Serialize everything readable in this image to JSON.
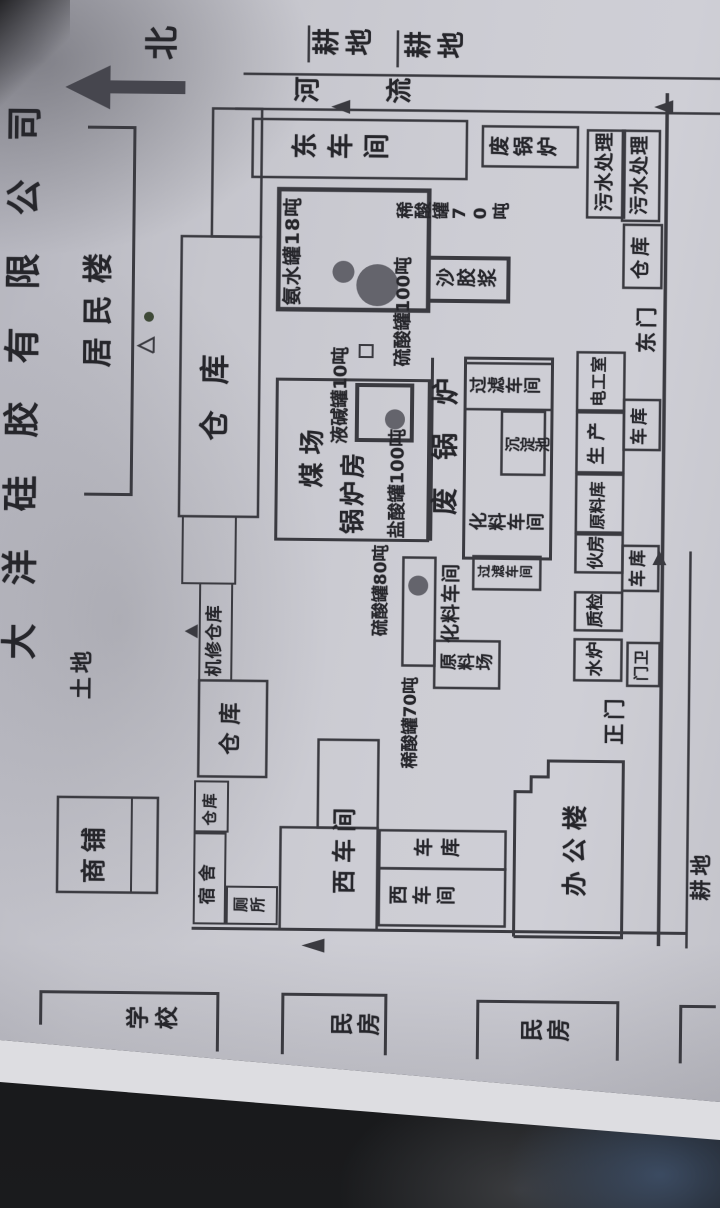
{
  "title": {
    "text": "大洋硅胶有限公司"
  },
  "colors": {
    "ink": "#3a3a40",
    "text": "#26262b",
    "tank_fill": "#64646c",
    "paper": "#c9c9d0"
  },
  "map": {
    "labels": [
      {
        "name": "company-title",
        "text": "大洋硅胶有限公司",
        "x": 545,
        "y": 2,
        "fs": 36,
        "ls": 38,
        "o": "h"
      },
      {
        "name": "north-label",
        "text": "北",
        "x": 1146,
        "y": 140,
        "fs": 34,
        "o": "h"
      },
      {
        "name": "farmland-east-1",
        "text": "耕地",
        "x": 1148,
        "y": 306,
        "fs": 27,
        "ls": 6,
        "o": "v"
      },
      {
        "name": "farmland-east-2",
        "text": "耕地",
        "x": 1146,
        "y": 398,
        "fs": 27,
        "ls": 6,
        "o": "v"
      },
      {
        "name": "river-label",
        "text": "河流",
        "x": 1101,
        "y": 288,
        "fs": 26,
        "ls": 66,
        "o": "v"
      },
      {
        "name": "land-label",
        "text": "土地",
        "x": 506,
        "y": 72,
        "fs": 22,
        "ls": 4,
        "o": "h"
      },
      {
        "name": "residents-building",
        "text": "居民楼",
        "x": 838,
        "y": 80,
        "fs": 30,
        "ls": 12,
        "o": "h"
      },
      {
        "name": "shops",
        "text": "商铺",
        "x": 322,
        "y": 84,
        "fs": 25,
        "ls": 6,
        "o": "h"
      },
      {
        "name": "warehouse-band",
        "text": "仓库",
        "x": 766,
        "y": 198,
        "fs": 30,
        "ls": 26,
        "o": "h"
      },
      {
        "name": "machine-repair-warehouse",
        "text": "机修仓库",
        "x": 530,
        "y": 207,
        "fs": 17,
        "ls": 1,
        "o": "h"
      },
      {
        "name": "warehouse-big",
        "text": "仓库",
        "x": 452,
        "y": 221,
        "fs": 22,
        "ls": 8,
        "o": "h"
      },
      {
        "name": "warehouse-small",
        "text": "仓库",
        "x": 381,
        "y": 205,
        "fs": 15,
        "ls": 2,
        "o": "h"
      },
      {
        "name": "dormitory",
        "text": "宿舍",
        "x": 302,
        "y": 203,
        "fs": 17,
        "ls": 6,
        "o": "h"
      },
      {
        "name": "toilet",
        "text": "厕所",
        "x": 293,
        "y": 236,
        "fs": 15,
        "ls": 2,
        "o": "v"
      },
      {
        "name": "east-workshop",
        "text": "东车间",
        "x": 1045,
        "y": 286,
        "fs": 26,
        "ls": 10,
        "o": "v"
      },
      {
        "name": "waste-boiler-room",
        "text": "废锅炉",
        "x": 1051,
        "y": 484,
        "fs": 20,
        "ls": 4,
        "o": "v"
      },
      {
        "name": "sewage-treatment-1",
        "text": "污水处理",
        "x": 999,
        "y": 591,
        "fs": 19,
        "ls": 1,
        "o": "h"
      },
      {
        "name": "sewage-treatment-2",
        "text": "污水处理",
        "x": 996,
        "y": 626,
        "fs": 19,
        "ls": 1,
        "o": "h"
      },
      {
        "name": "warehouse-east",
        "text": "仓库",
        "x": 932,
        "y": 628,
        "fs": 19,
        "ls": 4,
        "o": "h"
      },
      {
        "name": "east-gate",
        "text": "东门",
        "x": 858,
        "y": 633,
        "fs": 21,
        "ls": 4,
        "o": "h"
      },
      {
        "name": "ammonia-tank-18t",
        "text": "氨水罐18吨",
        "x": 902,
        "y": 280,
        "fs": 19,
        "ls": 1,
        "o": "h"
      },
      {
        "name": "sulfuric-acid-tank-100t",
        "text": "硫酸罐100吨",
        "x": 842,
        "y": 392,
        "fs": 18,
        "ls": 0,
        "o": "h"
      },
      {
        "name": "dilute-acid-tank-70t-a",
        "text": "稀酸罐70吨",
        "x": 986,
        "y": 392,
        "fs": 17,
        "ls": 1,
        "o": "v"
      },
      {
        "name": "sand-gel-slurry",
        "text": "沙胶浆",
        "x": 919,
        "y": 432,
        "fs": 19,
        "ls": 2,
        "o": "v"
      },
      {
        "name": "coal-yard",
        "text": "煤场",
        "x": 720,
        "y": 298,
        "fs": 25,
        "ls": 8,
        "o": "h"
      },
      {
        "name": "boiler-room",
        "text": "锅炉房",
        "x": 674,
        "y": 339,
        "fs": 25,
        "ls": 3,
        "o": "h"
      },
      {
        "name": "liquid-caustic-tank-10t",
        "text": "液碱罐10吨",
        "x": 764,
        "y": 330,
        "fs": 18,
        "ls": 0,
        "o": "h"
      },
      {
        "name": "hydrochloric-tank-100t",
        "text": "盐酸罐100吨",
        "x": 670,
        "y": 388,
        "fs": 18,
        "ls": 0,
        "o": "h"
      },
      {
        "name": "waste-boiler-big",
        "text": "废锅炉",
        "x": 694,
        "y": 431,
        "fs": 27,
        "ls": 28,
        "o": "h"
      },
      {
        "name": "filter-workshop-1",
        "text": "过滤车间",
        "x": 812,
        "y": 467,
        "fs": 17,
        "ls": 1,
        "o": "v"
      },
      {
        "name": "sedimentation-pool",
        "text": "沉淀池",
        "x": 756,
        "y": 503,
        "fs": 15,
        "ls": 0,
        "o": "v"
      },
      {
        "name": "chemical-workshop-1",
        "text": "化料车间",
        "x": 676,
        "y": 468,
        "fs": 18,
        "ls": 1,
        "o": "v"
      },
      {
        "name": "filter-workshop-2",
        "text": "过滤车间",
        "x": 629,
        "y": 477,
        "fs": 13,
        "ls": 1,
        "o": "v"
      },
      {
        "name": "chemical-workshop-2",
        "text": "化料车间",
        "x": 566,
        "y": 442,
        "fs": 19,
        "ls": 1,
        "o": "h"
      },
      {
        "name": "raw-material-yard",
        "text": "原料场",
        "x": 535,
        "y": 440,
        "fs": 17,
        "ls": 1,
        "o": "v"
      },
      {
        "name": "sulfuric-acid-tank-80t",
        "text": "硫酸罐80吨",
        "x": 572,
        "y": 373,
        "fs": 17,
        "ls": 0,
        "o": "h"
      },
      {
        "name": "dilute-acid-tank-70t-b",
        "text": "稀酸罐70吨",
        "x": 440,
        "y": 404,
        "fs": 17,
        "ls": 0,
        "o": "h"
      },
      {
        "name": "water-boiler",
        "text": "水炉",
        "x": 534,
        "y": 588,
        "fs": 17,
        "ls": 1,
        "o": "h"
      },
      {
        "name": "quality-check",
        "text": "质检",
        "x": 583,
        "y": 588,
        "fs": 17,
        "ls": 0,
        "o": "h"
      },
      {
        "name": "kitchen",
        "text": "伙房",
        "x": 641,
        "y": 588,
        "fs": 17,
        "ls": 0,
        "o": "h"
      },
      {
        "name": "raw-material-warehouse",
        "text": "原料库",
        "x": 681,
        "y": 589,
        "fs": 16,
        "ls": 0,
        "o": "h"
      },
      {
        "name": "production",
        "text": "生产",
        "x": 746,
        "y": 587,
        "fs": 18,
        "ls": 6,
        "o": "h"
      },
      {
        "name": "electrician-room",
        "text": "电工室",
        "x": 804,
        "y": 589,
        "fs": 16,
        "ls": 1,
        "o": "h"
      },
      {
        "name": "gate-guard",
        "text": "门卫",
        "x": 530,
        "y": 635,
        "fs": 15,
        "ls": 1,
        "o": "h"
      },
      {
        "name": "garage-2",
        "text": "车库",
        "x": 624,
        "y": 630,
        "fs": 17,
        "ls": 3,
        "o": "h"
      },
      {
        "name": "garage-1",
        "text": "车库",
        "x": 766,
        "y": 630,
        "fs": 17,
        "ls": 3,
        "o": "h"
      },
      {
        "name": "main-gate",
        "text": "正门",
        "x": 466,
        "y": 605,
        "fs": 21,
        "ls": 4,
        "o": "h"
      },
      {
        "name": "west-workshop-1",
        "text": "西车间",
        "x": 314,
        "y": 335,
        "fs": 24,
        "ls": 7,
        "o": "h"
      },
      {
        "name": "garage-strip",
        "text": "车库",
        "x": 349,
        "y": 416,
        "fs": 19,
        "ls": 8,
        "o": "v"
      },
      {
        "name": "west-workshop-2",
        "text": "西车间",
        "x": 301,
        "y": 391,
        "fs": 19,
        "ls": 5,
        "o": "v"
      },
      {
        "name": "office-building",
        "text": "办公楼",
        "x": 314,
        "y": 565,
        "fs": 25,
        "ls": 8,
        "o": "h"
      },
      {
        "name": "school",
        "text": "学校",
        "x": 173,
        "y": 130,
        "fs": 23,
        "ls": 6,
        "o": "v"
      },
      {
        "name": "civilian-house-1",
        "text": "民房",
        "x": 169,
        "y": 334,
        "fs": 23,
        "ls": 4,
        "o": "v"
      },
      {
        "name": "civilian-house-2",
        "text": "民房",
        "x": 165,
        "y": 524,
        "fs": 23,
        "ls": 4,
        "o": "v"
      },
      {
        "name": "farmland-south",
        "text": "耕地",
        "x": 311,
        "y": 693,
        "fs": 21,
        "ls": 4,
        "o": "h"
      }
    ],
    "shapes": [
      {
        "name": "north-arrow-shaft",
        "k": "g",
        "pts": "1112,98 1125,98 1125,180 1112,180",
        "f": "#46464e"
      },
      {
        "name": "north-arrow-head",
        "k": "g",
        "pts": "1096,105 1140,105 1118,60",
        "f": "#46464e"
      },
      {
        "name": "field-tick-1",
        "k": "l",
        "x1": 1145,
        "y1": 303,
        "x2": 1182,
        "y2": 303,
        "sw": 2.5
      },
      {
        "name": "field-tick-2",
        "k": "l",
        "x1": 1141,
        "y1": 392,
        "x2": 1178,
        "y2": 392,
        "sw": 2.5
      },
      {
        "name": "river-line-outer",
        "k": "l",
        "x1": 1133,
        "y1": 238,
        "x2": 1133,
        "y2": 720,
        "sw": 2.5
      },
      {
        "name": "river-line-inner",
        "k": "l",
        "x1": 1098,
        "y1": 230,
        "x2": 1098,
        "y2": 720,
        "sw": 2.5
      },
      {
        "name": "river-flow-arrow-1",
        "k": "g",
        "pts": "1094,345 1108,345 1101,326",
        "f": "#3a3a40"
      },
      {
        "name": "river-flow-arrow-2",
        "k": "g",
        "pts": "1097,668 1111,668 1104,649",
        "f": "#3a3a40"
      },
      {
        "name": "residents-line",
        "k": "p",
        "pts": "711,83 711,130 1078,130 1078,83",
        "sw": 3
      },
      {
        "name": "residents-dot",
        "k": "c",
        "cx": 889,
        "cy": 146,
        "r": 5,
        "f": "#3f4a38"
      },
      {
        "name": "residents-triangle",
        "k": "p",
        "pts": "853,151 860,136 868,151 853,151",
        "sw": 2
      },
      {
        "name": "shop-rect",
        "k": "r",
        "x": 313,
        "y": 60,
        "w": 95,
        "h": 100,
        "sw": 2.5
      },
      {
        "name": "shop-divider",
        "k": "l",
        "x1": 313,
        "y1": 134,
        "x2": 408,
        "y2": 134,
        "sw": 2
      },
      {
        "name": "warehouse-a-rect",
        "k": "r",
        "x": 970,
        "y": 208,
        "w": 128,
        "h": 49,
        "sw": 2.5
      },
      {
        "name": "warehouse-band-rect",
        "k": "r",
        "x": 690,
        "y": 178,
        "w": 280,
        "h": 79,
        "sw": 2.5
      },
      {
        "name": "warehouse-c-rect",
        "k": "r",
        "x": 623,
        "y": 182,
        "w": 67,
        "h": 53,
        "sw": 2
      },
      {
        "name": "machine-repair-rect",
        "k": "r",
        "x": 526,
        "y": 200,
        "w": 97,
        "h": 32,
        "sw": 2
      },
      {
        "name": "north-gate-marker",
        "k": "g",
        "pts": "568,198 582,198 575,185",
        "f": "#3a3a40"
      },
      {
        "name": "warehouse-big-rect",
        "k": "r",
        "x": 430,
        "y": 200,
        "w": 96,
        "h": 68,
        "sw": 2.5
      },
      {
        "name": "warehouse-small-rect",
        "k": "r",
        "x": 375,
        "y": 197,
        "w": 50,
        "h": 33,
        "sw": 2
      },
      {
        "name": "dormitory-rect",
        "k": "r",
        "x": 283,
        "y": 197,
        "w": 90,
        "h": 31,
        "sw": 2
      },
      {
        "name": "toilet-rect",
        "k": "r",
        "x": 283,
        "y": 230,
        "w": 37,
        "h": 50,
        "sw": 2
      },
      {
        "name": "east-workshop-rect",
        "k": "r",
        "x": 1030,
        "y": 248,
        "w": 58,
        "h": 214,
        "sw": 2.5
      },
      {
        "name": "waste-boiler-small-rect",
        "k": "r",
        "x": 1043,
        "y": 478,
        "w": 40,
        "h": 95,
        "sw": 2.5
      },
      {
        "name": "sewage1-rect",
        "k": "r",
        "x": 993,
        "y": 583,
        "w": 87,
        "h": 37,
        "sw": 2.5
      },
      {
        "name": "sewage2-rect",
        "k": "r",
        "x": 990,
        "y": 618,
        "w": 90,
        "h": 37,
        "sw": 2.5
      },
      {
        "name": "warehouse-east-rect",
        "k": "r",
        "x": 923,
        "y": 620,
        "w": 63,
        "h": 38,
        "sw": 2.5
      },
      {
        "name": "tank-square",
        "k": "r",
        "x": 898,
        "y": 275,
        "w": 120,
        "h": 150,
        "sw": 4.5
      },
      {
        "name": "ammonia-circle-small",
        "k": "c",
        "cx": 936,
        "cy": 340,
        "r": 11,
        "f": "#64646c"
      },
      {
        "name": "ammonia-circle-big",
        "k": "c",
        "cx": 923,
        "cy": 374,
        "r": 21,
        "f": "#64646c"
      },
      {
        "name": "slurry-rect",
        "k": "r",
        "x": 908,
        "y": 425,
        "w": 43,
        "h": 80,
        "sw": 4
      },
      {
        "name": "coal-boiler-rect",
        "k": "r",
        "x": 668,
        "y": 275,
        "w": 160,
        "h": 152,
        "sw": 3
      },
      {
        "name": "boiler-tank-square",
        "k": "r",
        "x": 768,
        "y": 355,
        "w": 55,
        "h": 55,
        "sw": 4
      },
      {
        "name": "boiler-tank-circle",
        "k": "c",
        "cx": 789,
        "cy": 393,
        "r": 10,
        "f": "#64646c"
      },
      {
        "name": "tiny-square",
        "k": "r",
        "x": 851,
        "y": 357,
        "w": 12,
        "h": 13,
        "sw": 2
      },
      {
        "name": "corridor-line",
        "k": "l",
        "x1": 668,
        "y1": 430,
        "x2": 851,
        "y2": 430,
        "sw": 3
      },
      {
        "name": "chemical-cluster-rect",
        "k": "r",
        "x": 651,
        "y": 463,
        "w": 200,
        "h": 87,
        "sw": 3
      },
      {
        "name": "filter1-rect",
        "k": "r",
        "x": 800,
        "y": 463,
        "w": 46,
        "h": 87,
        "sw": 2.5
      },
      {
        "name": "sedimentation-rect",
        "k": "r",
        "x": 735,
        "y": 500,
        "w": 63,
        "h": 43,
        "sw": 2.5
      },
      {
        "name": "filter2-rect",
        "k": "r",
        "x": 620,
        "y": 473,
        "w": 33,
        "h": 67,
        "sw": 2.5
      },
      {
        "name": "raw-yard-rect",
        "k": "r",
        "x": 521,
        "y": 435,
        "w": 47,
        "h": 65,
        "sw": 2.5
      },
      {
        "name": "tank-strip-rect",
        "k": "r",
        "x": 543,
        "y": 403,
        "w": 108,
        "h": 32,
        "sw": 2.5
      },
      {
        "name": "tank-strip-circle",
        "k": "c",
        "cx": 623,
        "cy": 418,
        "r": 10,
        "f": "#64646c"
      },
      {
        "name": "room-water-boiler",
        "k": "r",
        "x": 530,
        "y": 575,
        "w": 41,
        "h": 47,
        "sw": 2.5
      },
      {
        "name": "room-quality",
        "k": "r",
        "x": 580,
        "y": 575,
        "w": 38,
        "h": 47,
        "sw": 2.5
      },
      {
        "name": "room-kitchen",
        "k": "r",
        "x": 638,
        "y": 575,
        "w": 38,
        "h": 47,
        "sw": 2.5
      },
      {
        "name": "room-raw-warehouse",
        "k": "r",
        "x": 678,
        "y": 575,
        "w": 58,
        "h": 47,
        "sw": 2.5
      },
      {
        "name": "room-production",
        "k": "r",
        "x": 738,
        "y": 575,
        "w": 60,
        "h": 47,
        "sw": 2.5
      },
      {
        "name": "room-electrician",
        "k": "r",
        "x": 800,
        "y": 575,
        "w": 58,
        "h": 47,
        "sw": 2.5
      },
      {
        "name": "room-gate-guard",
        "k": "r",
        "x": 525,
        "y": 628,
        "w": 43,
        "h": 32,
        "sw": 2.5
      },
      {
        "name": "room-garage-2",
        "k": "r",
        "x": 620,
        "y": 622,
        "w": 45,
        "h": 36,
        "sw": 2.5
      },
      {
        "name": "room-garage-1",
        "k": "r",
        "x": 761,
        "y": 622,
        "w": 50,
        "h": 36,
        "sw": 2.5
      },
      {
        "name": "garage-row-top-line",
        "k": "l",
        "x1": 665,
        "y1": 622,
        "x2": 761,
        "y2": 622,
        "sw": 2
      },
      {
        "name": "south-wall",
        "k": "l",
        "x1": 265,
        "y1": 662,
        "x2": 1118,
        "y2": 662,
        "sw": 3.5
      },
      {
        "name": "south-road-line",
        "k": "l",
        "x1": 263,
        "y1": 690,
        "x2": 660,
        "y2": 690,
        "sw": 2.5
      },
      {
        "name": "south-gate-marker",
        "k": "g",
        "pts": "646,652 646,666 660,659",
        "f": "#3a3a40"
      },
      {
        "name": "west-wall",
        "k": "l",
        "x1": 278,
        "y1": 195,
        "x2": 278,
        "y2": 690,
        "sw": 3
      },
      {
        "name": "west-gate-marker",
        "k": "g",
        "pts": "255,328 269,328 262,305",
        "f": "#3a3a40"
      },
      {
        "name": "west-workshop-wing",
        "k": "r",
        "x": 380,
        "y": 320,
        "w": 88,
        "h": 60,
        "sw": 2.5
      },
      {
        "name": "west-workshop-main",
        "k": "r",
        "x": 278,
        "y": 283,
        "w": 102,
        "h": 97,
        "sw": 2.5
      },
      {
        "name": "garage-strip-rect",
        "k": "r",
        "x": 340,
        "y": 382,
        "w": 38,
        "h": 126,
        "sw": 2.5
      },
      {
        "name": "west-workshop2-rect",
        "k": "r",
        "x": 283,
        "y": 382,
        "w": 57,
        "h": 126,
        "sw": 2.5
      },
      {
        "name": "office-outline",
        "k": "p",
        "pts": "273,517 418,517 418,533 433,533 433,550 449,550 449,625 273,625 273,517",
        "sw": 3
      },
      {
        "name": "school-bracket",
        "k": "p",
        "pts": "180,45 213,45 213,222 155,222",
        "sw": 3
      },
      {
        "name": "civilian1-bracket",
        "k": "p",
        "pts": "153,287 213,287 213,390 153,390",
        "sw": 3
      },
      {
        "name": "civilian2-bracket",
        "k": "p",
        "pts": "150,482 208,482 208,622 150,622",
        "sw": 3
      },
      {
        "name": "civilian3-bracket",
        "k": "p",
        "pts": "148,685 205,685 205,720",
        "sw": 3
      }
    ]
  }
}
